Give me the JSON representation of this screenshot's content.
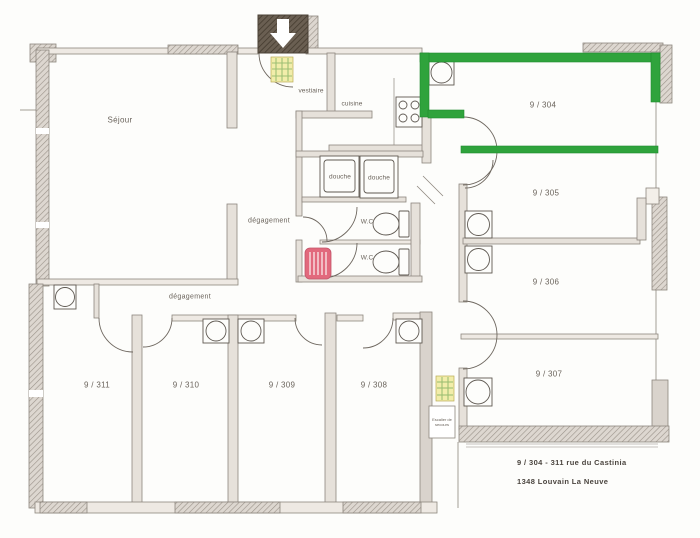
{
  "plan": {
    "rooms": {
      "sejour": "Séjour",
      "vestiaire": "vestiaire",
      "cuisine": "cuisine",
      "douche_left": "douche",
      "douche_right": "douche",
      "wc_top": "W.C",
      "wc_bottom": "W.C",
      "degagement_upper": "dégagement",
      "degagement_lower": "dégagement",
      "room_304": "9 / 304",
      "room_305": "9 / 305",
      "room_306": "9 / 306",
      "room_307": "9 / 307",
      "room_308": "9 / 308",
      "room_309": "9 / 309",
      "room_310": "9 / 310",
      "room_311": "9 / 311"
    },
    "exit_label": "Escalier de secours",
    "address": {
      "line1": "9 / 304 - 311 rue du Castinia",
      "line2": "1348 Louvain La Neuve"
    },
    "colors": {
      "highlight_green": "#2fa33c",
      "radiator_red": "#e2697d",
      "mat_yellow": "#f2edaa",
      "mat_grid_green": "#9dbf74",
      "address_text": "#4a443e",
      "label_text": "#6a635b"
    }
  }
}
